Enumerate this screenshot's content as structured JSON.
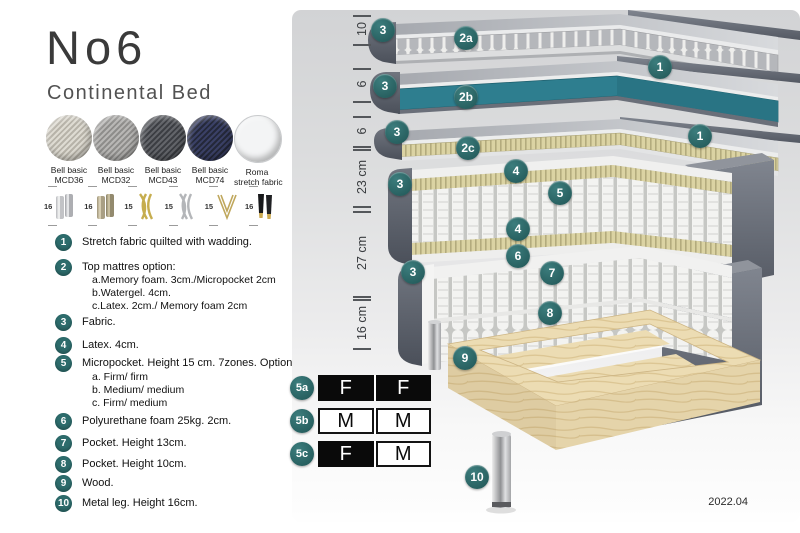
{
  "title": "No6",
  "subtitle": "Continental Bed",
  "swatches": [
    {
      "line1": "Bell basic",
      "line2": "MCD36",
      "color": "#d8d4cb"
    },
    {
      "line1": "Bell basic",
      "line2": "MCD32",
      "color": "#a7a6a4"
    },
    {
      "line1": "Bell basic",
      "line2": "MCD43",
      "color": "#53555a"
    },
    {
      "line1": "Bell basic",
      "line2": "MCD74",
      "color": "#2f3452"
    },
    {
      "line1": "Roma",
      "line2": "stretch fabric",
      "color": "#f4f5f6"
    }
  ],
  "leg_options": [
    {
      "size": "16",
      "type": "cylinder-silver"
    },
    {
      "size": "16",
      "type": "cylinder-brass"
    },
    {
      "size": "15",
      "type": "twist-gold"
    },
    {
      "size": "15",
      "type": "twist-silver"
    },
    {
      "size": "15",
      "type": "hairpin-gold"
    },
    {
      "size": "16",
      "type": "taper-black-gold"
    }
  ],
  "features": [
    {
      "num": "1",
      "text": "Stretch fabric quilted with wadding."
    },
    {
      "num": "2",
      "text": "Top mattres option:",
      "subs": [
        "a.Memory foam. 3cm./Micropocket 2cm",
        "b.Watergel. 4cm.",
        "c.Latex. 2cm./ Memory foam 2cm"
      ]
    },
    {
      "num": "3",
      "text": "Fabric."
    },
    {
      "num": "4",
      "text": "Latex. 4cm."
    },
    {
      "num": "5",
      "text": "Micropocket. Height 15 cm. 7zones. Option:",
      "subs": [
        "a. Firm/ firm",
        "b. Medium/ medium",
        "c. Firm/ medium"
      ]
    },
    {
      "num": "6",
      "text": "Polyurethane foam 25kg. 2cm."
    },
    {
      "num": "7",
      "text": "Pocket. Height 13cm."
    },
    {
      "num": "8",
      "text": "Pocket. Height 10cm."
    },
    {
      "num": "9",
      "text": "Wood."
    },
    {
      "num": "10",
      "text": "Metal leg. Height 16cm."
    }
  ],
  "diagram": {
    "dimensions": [
      {
        "label": "10"
      },
      {
        "label": "6"
      },
      {
        "label": "6"
      },
      {
        "label": "23 cm"
      },
      {
        "label": "27 cm"
      },
      {
        "label": "16 cm"
      }
    ],
    "callouts": [
      {
        "label": "3"
      },
      {
        "label": "2a"
      },
      {
        "label": "1"
      },
      {
        "label": "3"
      },
      {
        "label": "2b"
      },
      {
        "label": "1"
      },
      {
        "label": "3"
      },
      {
        "label": "2c"
      },
      {
        "label": "3"
      },
      {
        "label": "4"
      },
      {
        "label": "5"
      },
      {
        "label": "4"
      },
      {
        "label": "6"
      },
      {
        "label": "7"
      },
      {
        "label": "3"
      },
      {
        "label": "8"
      },
      {
        "label": "9"
      },
      {
        "label": "10"
      }
    ],
    "firmness": [
      {
        "label": "5a",
        "cells": [
          {
            "text": "F",
            "variant": "dark"
          },
          {
            "text": "F",
            "variant": "dark"
          }
        ]
      },
      {
        "label": "5b",
        "cells": [
          {
            "text": "M",
            "variant": "light"
          },
          {
            "text": "M",
            "variant": "light"
          }
        ]
      },
      {
        "label": "5c",
        "cells": [
          {
            "text": "F",
            "variant": "dark"
          },
          {
            "text": "M",
            "variant": "light"
          }
        ]
      }
    ],
    "version": "2022.04"
  },
  "colors": {
    "accent_teal": "#2d6c6c",
    "watergel_teal": "#2e7e8f",
    "latex_tan": "#d9d1a0",
    "wood": "#ecdcb2",
    "cover_gray": "#5f636d"
  }
}
